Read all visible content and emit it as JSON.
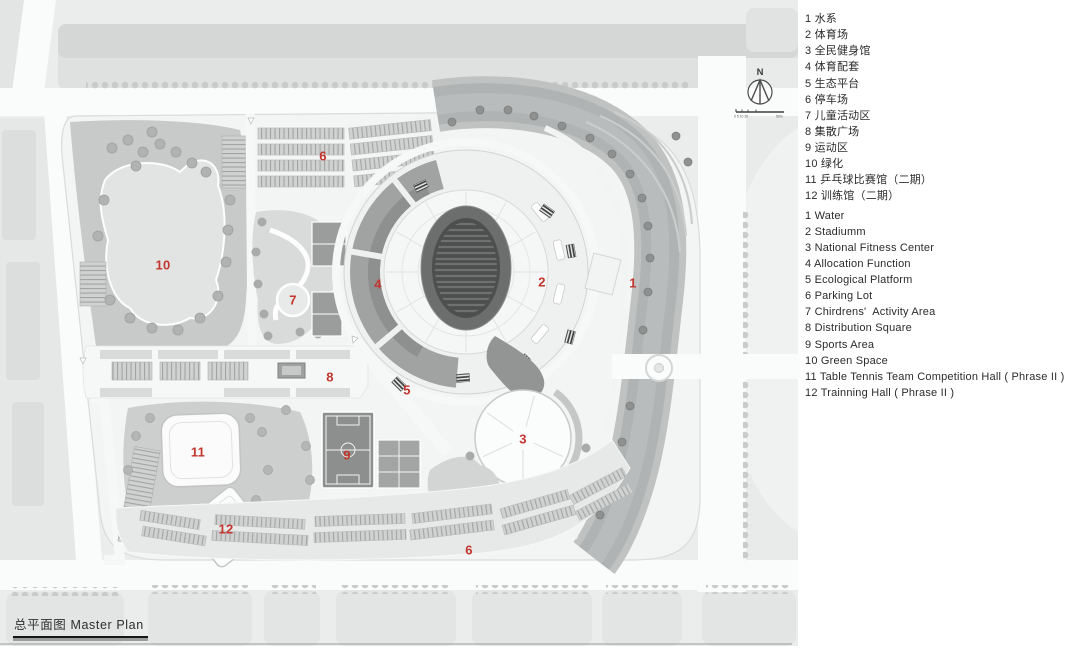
{
  "title_block": {
    "text": "总平面图 Master Plan"
  },
  "north": {
    "label": "N"
  },
  "scale_bar": {
    "left_text": "0 5 10 20",
    "right_text": "50m"
  },
  "legend": {
    "zh": [
      "1 水系",
      "2 体育场",
      "3 全民健身馆",
      "4 体育配套",
      "5 生态平台",
      "6 停车场",
      "7 儿童活动区",
      "8 集散广场",
      "9 运动区",
      "10 绿化",
      "11 乒乓球比赛馆（二期）",
      "12 训练馆（二期）"
    ],
    "en": [
      "1 Water",
      "2 Stadiumm",
      "3 National Fitness Center",
      "4 Allocation Function",
      "5 Ecological Platform",
      "6 Parking Lot",
      "7 Chirdrens'  Activity Area",
      "8 Distribution Square",
      "9 Sports Area",
      "10 Green Space",
      "11 Table Tennis Team Competition Hall ( Phrase II )",
      "12 Trainning Hall ( Phrase II )"
    ]
  },
  "plan": {
    "label_color": "#c2362e",
    "labels": [
      {
        "n": "1",
        "x": 633,
        "y": 283
      },
      {
        "n": "2",
        "x": 542,
        "y": 282
      },
      {
        "n": "3",
        "x": 523,
        "y": 439
      },
      {
        "n": "4",
        "x": 378,
        "y": 284
      },
      {
        "n": "5",
        "x": 407,
        "y": 390
      },
      {
        "n": "6",
        "x": 323,
        "y": 156
      },
      {
        "n": "6",
        "x": 469,
        "y": 550
      },
      {
        "n": "7",
        "x": 293,
        "y": 300
      },
      {
        "n": "8",
        "x": 330,
        "y": 377
      },
      {
        "n": "9",
        "x": 347,
        "y": 455
      },
      {
        "n": "10",
        "x": 163,
        "y": 265
      },
      {
        "n": "11",
        "x": 198,
        "y": 452
      },
      {
        "n": "12",
        "x": 226,
        "y": 529
      }
    ]
  }
}
